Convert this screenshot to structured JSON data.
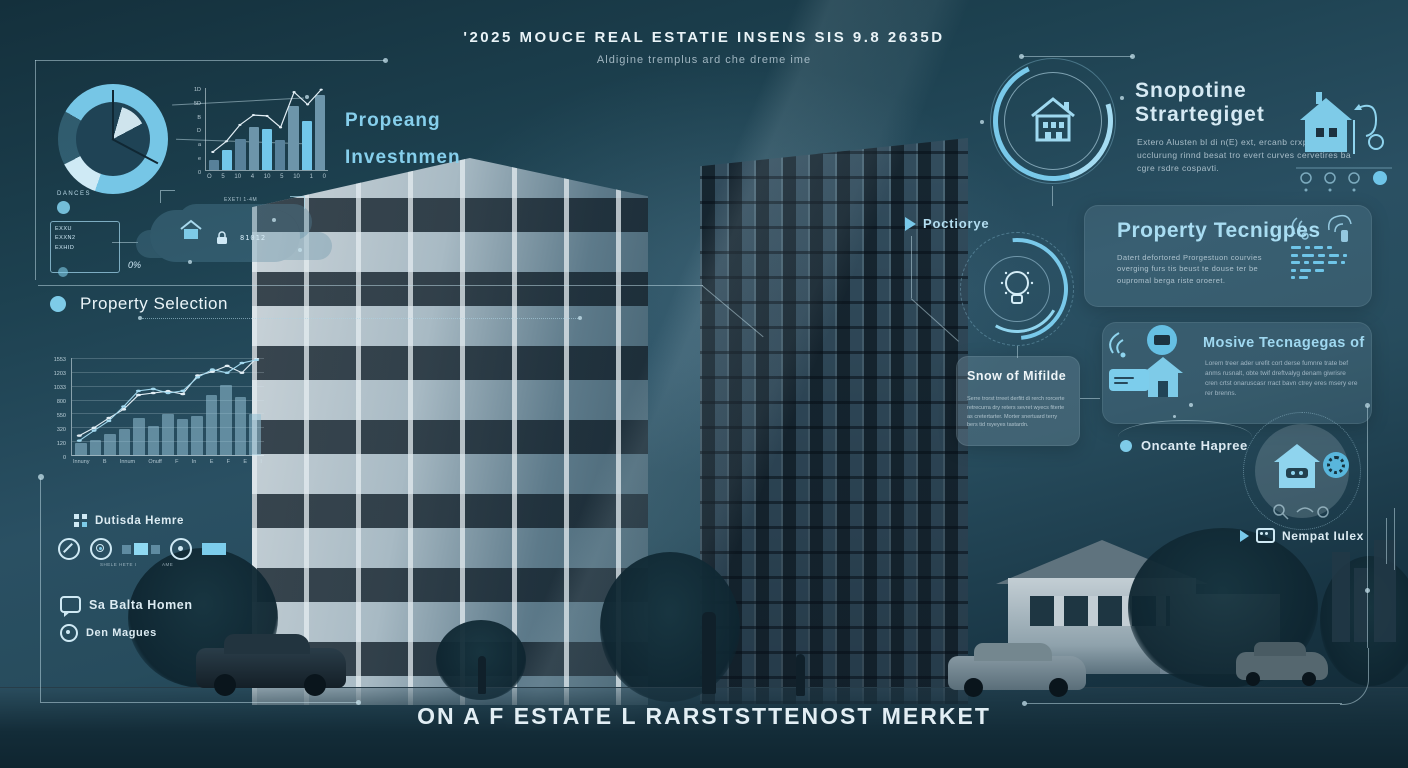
{
  "colors": {
    "accent": "#79c9ea",
    "accent_bright": "#a5dcf2",
    "bright": "#72c7ea",
    "muted": "#58819a",
    "steel": "#6d95aa",
    "market_bar": "rgba(148,193,214,0.55)",
    "line_white": "#e2eef5",
    "line_accent": "#a2d8ee",
    "text": "#e8f2f6"
  },
  "header": {
    "title": "'2025 MOUCE REAL ESTATIE INSENS SIS 9.8 2635D",
    "subtitle": "Aldigine tremplus ard che dreme ime"
  },
  "footer": {
    "title": "ON A F ESTATE L RARSTSTTENOST MERKET"
  },
  "left": {
    "investment_line1": "Propeang",
    "investment_line2": "Investnmen",
    "davos": {
      "label": "DANCES",
      "code_lines": [
        "EXXU",
        "EXXN2",
        "EXHID"
      ],
      "percent": "0%",
      "suffix": "ZD"
    },
    "cloud": {
      "digits": "81012",
      "tag": "EXETI 1-4M"
    },
    "property_selection": "Property Selection",
    "legend_outside": "Dutisda Hemre",
    "icon_caption_left": "SHELE HETE I",
    "icon_caption_right": "AME",
    "legend_chat": "Sa Balta Homen",
    "legend_circle": "Den Magues"
  },
  "right": {
    "strategy": {
      "heading1": "Snopotine",
      "heading2": "Strartegiget",
      "body": "Extero Alusten bl di n(E) ext, ercanb crxpel beriro ucclurung rinnd besat tro evert curves cervetires ba cgre rsdre cospavti."
    },
    "poctiorye": "Poctiorye",
    "property_panel": {
      "heading": "Property Tecnigpes",
      "body": "Datert defortored Prorgestuon courvies overging furs tis beust te douse ter be oupromal berga riste oroeret.",
      "dash_rows": [
        [
          10,
          5,
          9,
          5
        ],
        [
          7,
          12,
          7,
          10,
          4
        ],
        [
          9,
          5,
          11,
          9,
          4
        ],
        [
          5,
          11,
          9
        ],
        [
          4,
          9
        ]
      ]
    },
    "mosive_panel": {
      "heading": "Mosive Tecnagegas of",
      "body": "Lorem treer ader urefit cort derse fumnre trate bef anms rusnalt, obte twif dreftvalyg denam giwrisre cren crtst onaruscasr rract bavn ctrey eres msery ere rer brenns."
    },
    "snow_panel": {
      "heading": "Snow of Mifilde",
      "body": "Serre trorst trreet derfitt di rerch rorcerte retrecurra dry reters sevret wyecs fiterte as cretertarter. Morter snertuard terry bers tid rsyeyes tastardn."
    },
    "oncante": "Oncante Hapree",
    "nempati": "Nempat Iulex"
  },
  "chart_data": [
    {
      "id": "allocation-donut",
      "type": "pie",
      "title": "",
      "start_angle": -60,
      "slices": [
        {
          "label": "primary",
          "value": 72,
          "color": "#76c6e6"
        },
        {
          "label": "highlight",
          "value": 12,
          "color": "#cfeaf5"
        },
        {
          "label": "remainder",
          "value": 16,
          "color": "rgba(118,198,230,0.25)"
        }
      ]
    },
    {
      "id": "mini-bar",
      "type": "bar",
      "title": "",
      "grid": false,
      "categories": [
        "O",
        "5",
        "10",
        "4",
        "10",
        "5",
        "10",
        "1",
        "0"
      ],
      "values": [
        12,
        25,
        38,
        52,
        50,
        37,
        78,
        60,
        92
      ],
      "ylim": [
        0,
        100
      ],
      "yticks": [
        "1D",
        "5D",
        "B",
        "D",
        "a",
        "e",
        "0"
      ],
      "bar_palette": [
        "muted",
        "bright",
        "muted",
        "steel",
        "bright",
        "muted",
        "steel",
        "bright",
        "steel"
      ],
      "lines": [
        {
          "name": "trend",
          "values": [
            22,
            35,
            55,
            67,
            66,
            52,
            95,
            80,
            98
          ],
          "color": "#e2eef5",
          "width": 1.2,
          "dots": true
        }
      ]
    },
    {
      "id": "market-bar",
      "type": "bar",
      "title": "",
      "grid": true,
      "categories": [
        "Innuny",
        "B",
        "Innum",
        "Onuff",
        "F",
        "In",
        "E",
        "F",
        "E",
        "I"
      ],
      "values": [
        190,
        230,
        340,
        420,
        590,
        465,
        650,
        570,
        620,
        960,
        1120,
        930,
        650
      ],
      "ylim": [
        0,
        1550
      ],
      "yticks": [
        "1553",
        "1203",
        "1033",
        "800",
        "550",
        "320",
        "120",
        "0"
      ],
      "bar_color": "rgba(148,193,214,0.55)",
      "lines": [
        {
          "name": "series-a",
          "values": [
            310,
            435,
            590,
            730,
            960,
            990,
            1020,
            975,
            1270,
            1330,
            1425,
            1315,
            1550
          ],
          "color": "#e2eef5",
          "width": 1.1,
          "dots": true
        },
        {
          "name": "series-b",
          "values": [
            230,
            390,
            545,
            775,
            1025,
            1055,
            990,
            1025,
            1240,
            1365,
            1315,
            1470,
            1520
          ],
          "color": "#a2d8ee",
          "width": 1.1,
          "dots": true
        }
      ]
    }
  ]
}
